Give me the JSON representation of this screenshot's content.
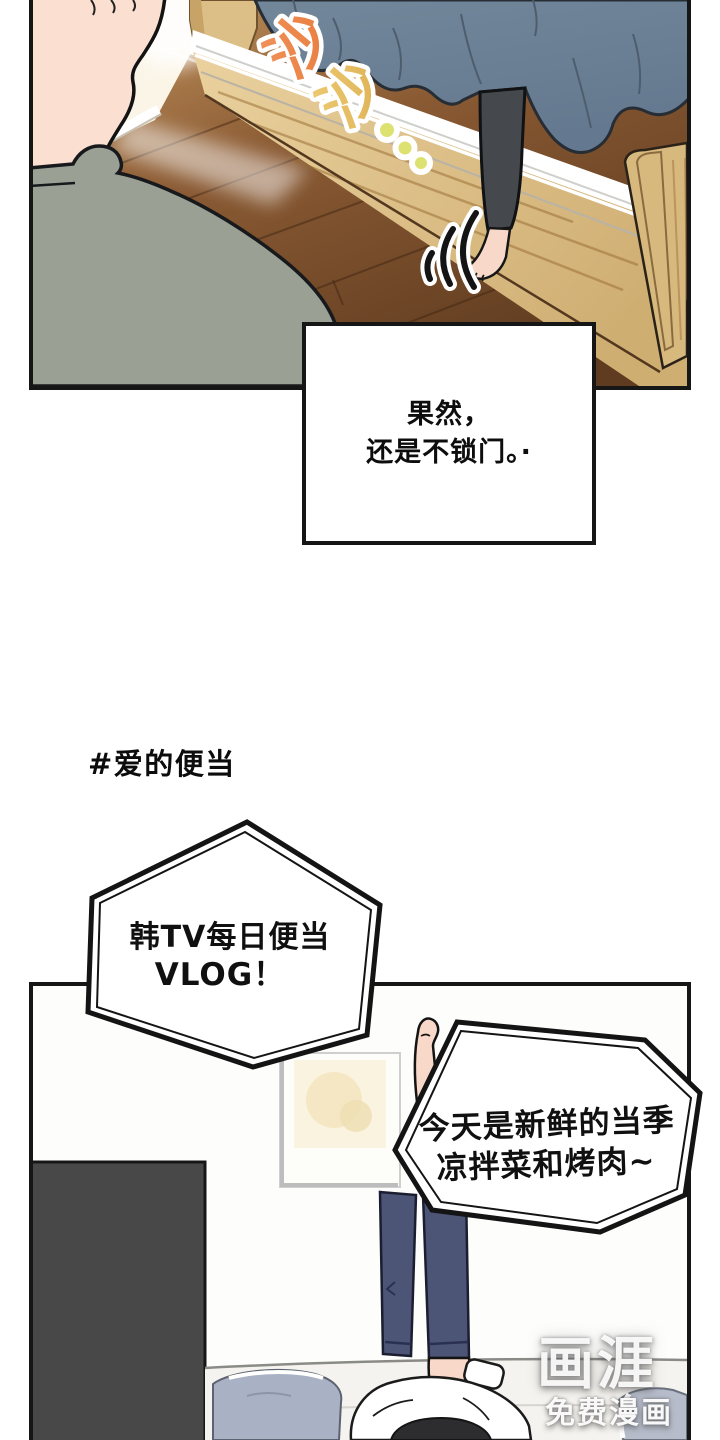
{
  "caption": {
    "line1": "果然，",
    "line2": "还是不锁门。·"
  },
  "hashtag": "#爱的便当",
  "bubble1": {
    "line1": "韩TV每日便当",
    "line2": "VLOG！"
  },
  "bubble2": {
    "line1": "今天是新鲜的当季",
    "line2": "凉拌菜和烤肉~"
  },
  "sfx": {
    "char1": "沙",
    "char2": "沙"
  },
  "watermark": {
    "logo": "画涯",
    "subtitle": "免费漫画"
  },
  "colors": {
    "panel_border": "#161616",
    "blanket": "#6e8299",
    "floor": "#7c5130",
    "bed_wood": "#d9ba7f",
    "shirt": "#9ba095",
    "skin": "#f8d8c8",
    "pants": "#4d5577",
    "wardrobe": "#484848",
    "pillow": "#a9b1c4",
    "sfx_orange": "#ee8a4d",
    "sfx_yellow": "#e6bd63",
    "sfx_dots": "#dde170"
  }
}
